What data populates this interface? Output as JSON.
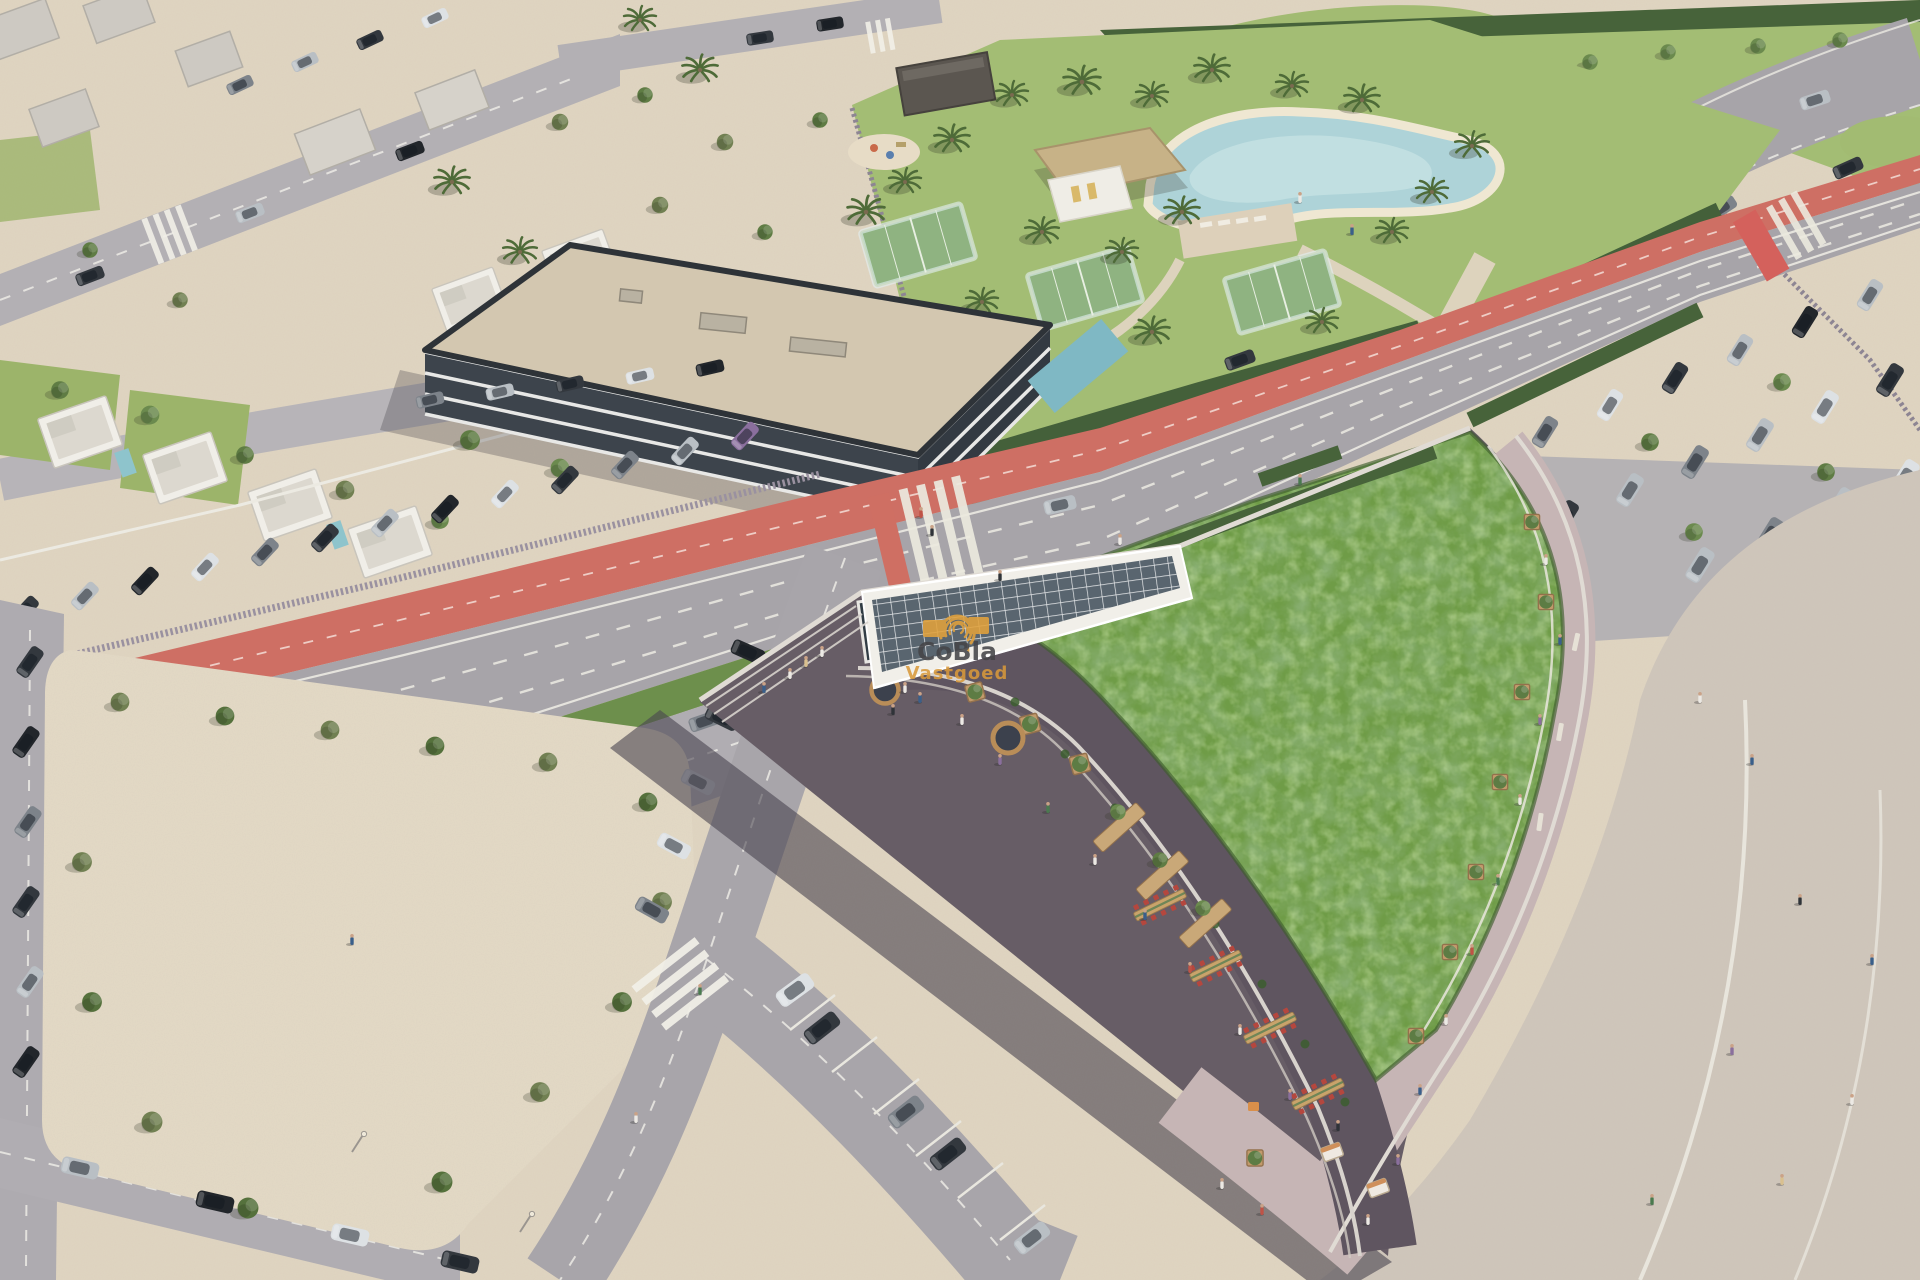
{
  "image": {
    "kind": "aerial architectural rendering",
    "summary": "Bird's-eye render of a commercial building with a green sedum roof and rooftop dining terrace, a main road with red bike lane, residential villas, an amenity lagoon pool with padel courts, and surrounding parking lots."
  },
  "watermark": {
    "brand": "CoBla",
    "tagline": "Vastgoed",
    "logo_icon": "fingerprint-arcs-icon",
    "brand_color": "#454548",
    "tagline_color": "#d8993b",
    "logo_color": "#e2a23c"
  },
  "palette": {
    "sand": "#e0d5c1",
    "plaza": "#e4dac6",
    "road": "#a7a4a9",
    "bike_lane": "#ce6f64",
    "hedge": "#5f8044",
    "lawn": "#a3bd74",
    "green_roof": "#6f9c47",
    "pool": "#aed3d8",
    "terrace_floor": "#5f5560",
    "promenade": "#c6b5b5",
    "boulevard": "#cfc6bb",
    "facade_dark": "#3d444c",
    "parapet": "#e0dbd4",
    "planter_wood": "#c19a6b",
    "chair_red": "#b5473e"
  }
}
